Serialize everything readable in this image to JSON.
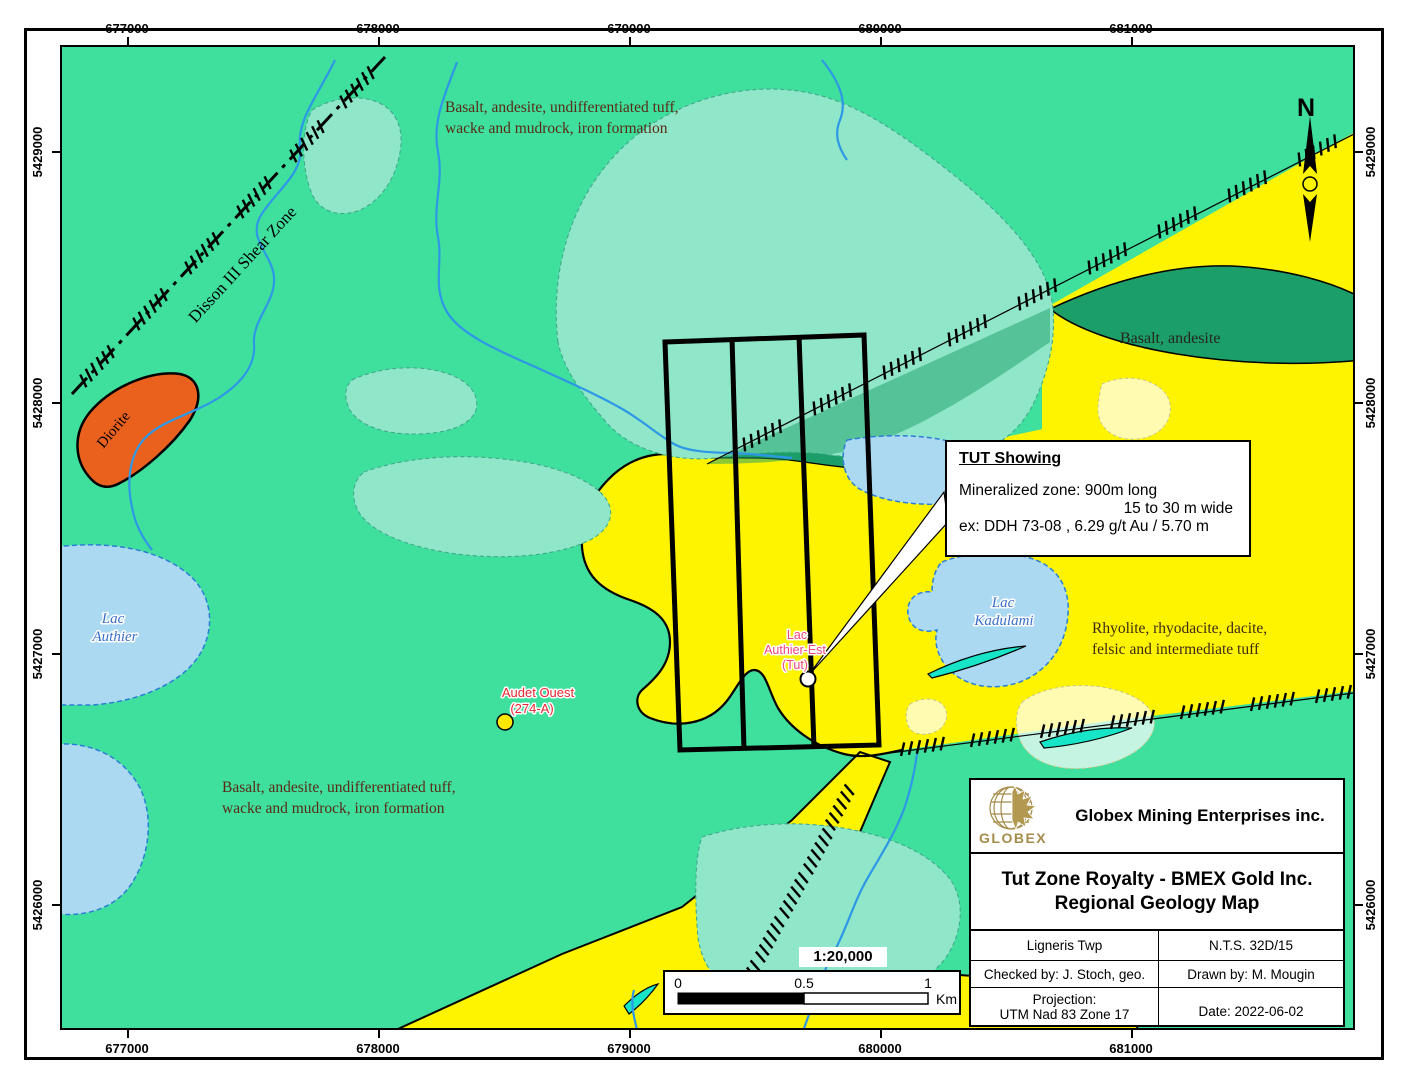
{
  "frame": {
    "north_label": "N",
    "scale_ratio": "1:20,000"
  },
  "coordinates": {
    "top": [
      "677000",
      "678000",
      "679000",
      "680000",
      "681000"
    ],
    "bottom": [
      "677000",
      "678000",
      "679000",
      "680000",
      "681000"
    ],
    "left": [
      "5429000",
      "5428000",
      "5427000",
      "5426000"
    ],
    "right": [
      "5429000",
      "5428000",
      "5427000",
      "5426000"
    ]
  },
  "geology_labels": {
    "unit_basalt_tuff_line1": "Basalt, andesite, undifferentiated tuff,",
    "unit_basalt_tuff_line2": "wacke and mudrock, iron formation",
    "unit_basalt_andesite": "Basalt, andesite",
    "unit_rhyolite_line1": "Rhyolite, rhyodacite, dacite,",
    "unit_rhyolite_line2": "felsic and intermediate tuff",
    "unit_diorite": "Diorite",
    "shear_zone": "Disson III Shear Zone"
  },
  "water_labels": {
    "lac_authier_line1": "Lac",
    "lac_authier_line2": "Authier",
    "lac_kadulami_line1": "Lac",
    "lac_kadulami_line2": "Kadulami"
  },
  "showings": {
    "tut_label_line1": "Lac",
    "tut_label_line2": "Authier-Est",
    "tut_label_line3": "(Tut)",
    "audet_line1": "Audet Ouest",
    "audet_line2": "(274-A)"
  },
  "callout": {
    "title": "TUT Showing",
    "line1": "Mineralized zone: 900m long",
    "line2": "15 to 30 m wide",
    "line3": "ex: DDH 73-08 , 6.29 g/t Au / 5.70 m"
  },
  "scalebar": {
    "tick0": "0",
    "tick_half": "0.5",
    "tick1": "1",
    "unit": "Km"
  },
  "title_block": {
    "company": "Globex Mining Enterprises inc.",
    "logo_text": "GLOBEX",
    "project_line1": "Tut Zone Royalty - BMEX Gold Inc.",
    "project_line2": "Regional Geology Map",
    "township": "Ligneris Twp",
    "nts": "N.T.S. 32D/15",
    "checked": "Checked by: J. Stoch, geo.",
    "drawn": "Drawn by: M. Mougin",
    "projection_label": "Projection:",
    "projection_value": "UTM Nad 83 Zone 17",
    "date": "Date: 2022-06-02"
  },
  "colors": {
    "background_green": "#3FDF9E",
    "rhyolite_yellow": "#FFF400",
    "basalt_dark_green": "#1C9E68",
    "wetland_teal": "#8FE6C8",
    "lake_blue": "#ABD9F2",
    "dyke_cyan": "#17E5C8",
    "diorite_orange": "#E9611C",
    "audet_label_red": "#E82530",
    "tut_label_pink": "#F0457C",
    "water_label_blue": "#3A6FC8",
    "geology_label_brown": "#5A2A15",
    "logo_gold": "#A58C4A"
  }
}
